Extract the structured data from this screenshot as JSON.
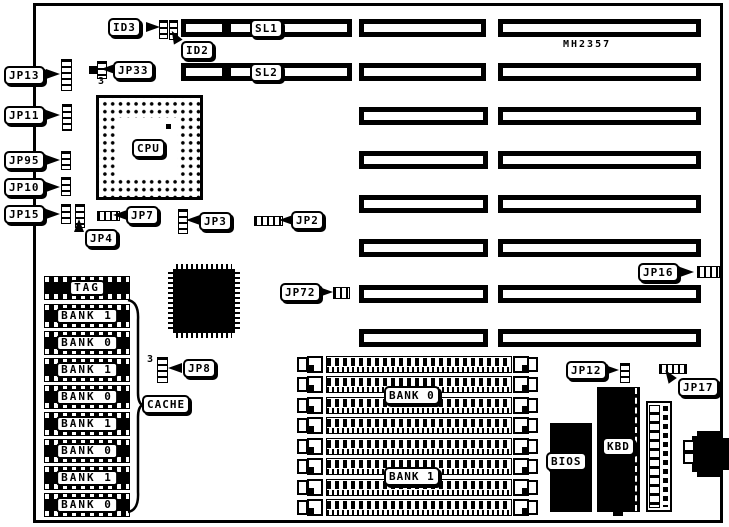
{
  "board": {
    "model": "MH2357",
    "ink": "#000000",
    "paper": "#ffffff"
  },
  "slots": {
    "sl1": "SL1",
    "sl2": "SL2",
    "unlabeled_rows": 6
  },
  "jumpers": {
    "id3": "ID3",
    "id2": "ID2",
    "jp33": "JP33",
    "jp13": "JP13",
    "jp11": "JP11",
    "jp95": "JP95",
    "jp10": "JP10",
    "jp15": "JP15",
    "jp4": "JP4",
    "jp7": "JP7",
    "jp3": "JP3",
    "jp2": "JP2",
    "jp8": "JP8",
    "jp72": "JP72",
    "jp16": "JP16",
    "jp12": "JP12",
    "jp17": "JP17"
  },
  "markers": {
    "jp33_pin": "3",
    "jp8_pin": "3"
  },
  "cpu": {
    "label": "CPU"
  },
  "cache": {
    "label": "CACHE",
    "chips": [
      "TAG",
      "BANK 1",
      "BANK 0",
      "BANK 1",
      "BANK 0",
      "BANK 1",
      "BANK 0",
      "BANK 1",
      "BANK 0"
    ]
  },
  "memory": {
    "bank0": "BANK 0",
    "bank1": "BANK 1",
    "simm_rows": 8
  },
  "chips": {
    "bios": "BIOS",
    "kbd": "KBD"
  }
}
